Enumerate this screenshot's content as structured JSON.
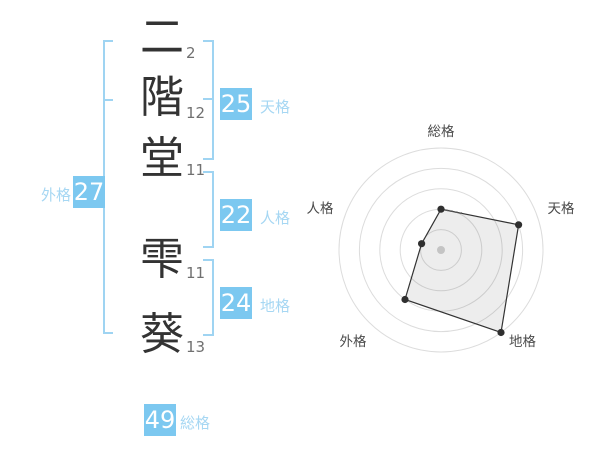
{
  "name_panel": {
    "characters": [
      {
        "char": "二",
        "strokes": "2"
      },
      {
        "char": "階",
        "strokes": "12"
      },
      {
        "char": "堂",
        "strokes": "11"
      },
      {
        "char": "雫",
        "strokes": "11"
      },
      {
        "char": "葵",
        "strokes": "13"
      }
    ],
    "badges": {
      "tenkaku": {
        "value": "25",
        "label": "天格"
      },
      "jinkaku": {
        "value": "22",
        "label": "人格"
      },
      "chikaku": {
        "value": "24",
        "label": "地格"
      },
      "gaikaku": {
        "value": "27",
        "label": "外格"
      },
      "soukaku": {
        "value": "49",
        "label": "総格"
      }
    }
  },
  "colors": {
    "badge_bg": "#7cc8f0",
    "label_text": "#a6d7f3",
    "bracket": "#9fd4f2",
    "character_text": "#333333",
    "stroke_count_text": "#707070",
    "ring": "#dcdcdc",
    "polygon_stroke": "#333333",
    "polygon_fill": "rgba(0,0,0,0.07)",
    "vertex_dot": "#2f2f2f",
    "center_dot": "#c4c4c4",
    "axis_label": "#4a4a4a"
  },
  "chart_data": {
    "type": "radar",
    "max": 5,
    "rings": 5,
    "axes": [
      {
        "label": "総格",
        "value": 2
      },
      {
        "label": "天格",
        "value": 4
      },
      {
        "label": "地格",
        "value": 5
      },
      {
        "label": "外格",
        "value": 3
      },
      {
        "label": "人格",
        "value": 1
      }
    ]
  }
}
